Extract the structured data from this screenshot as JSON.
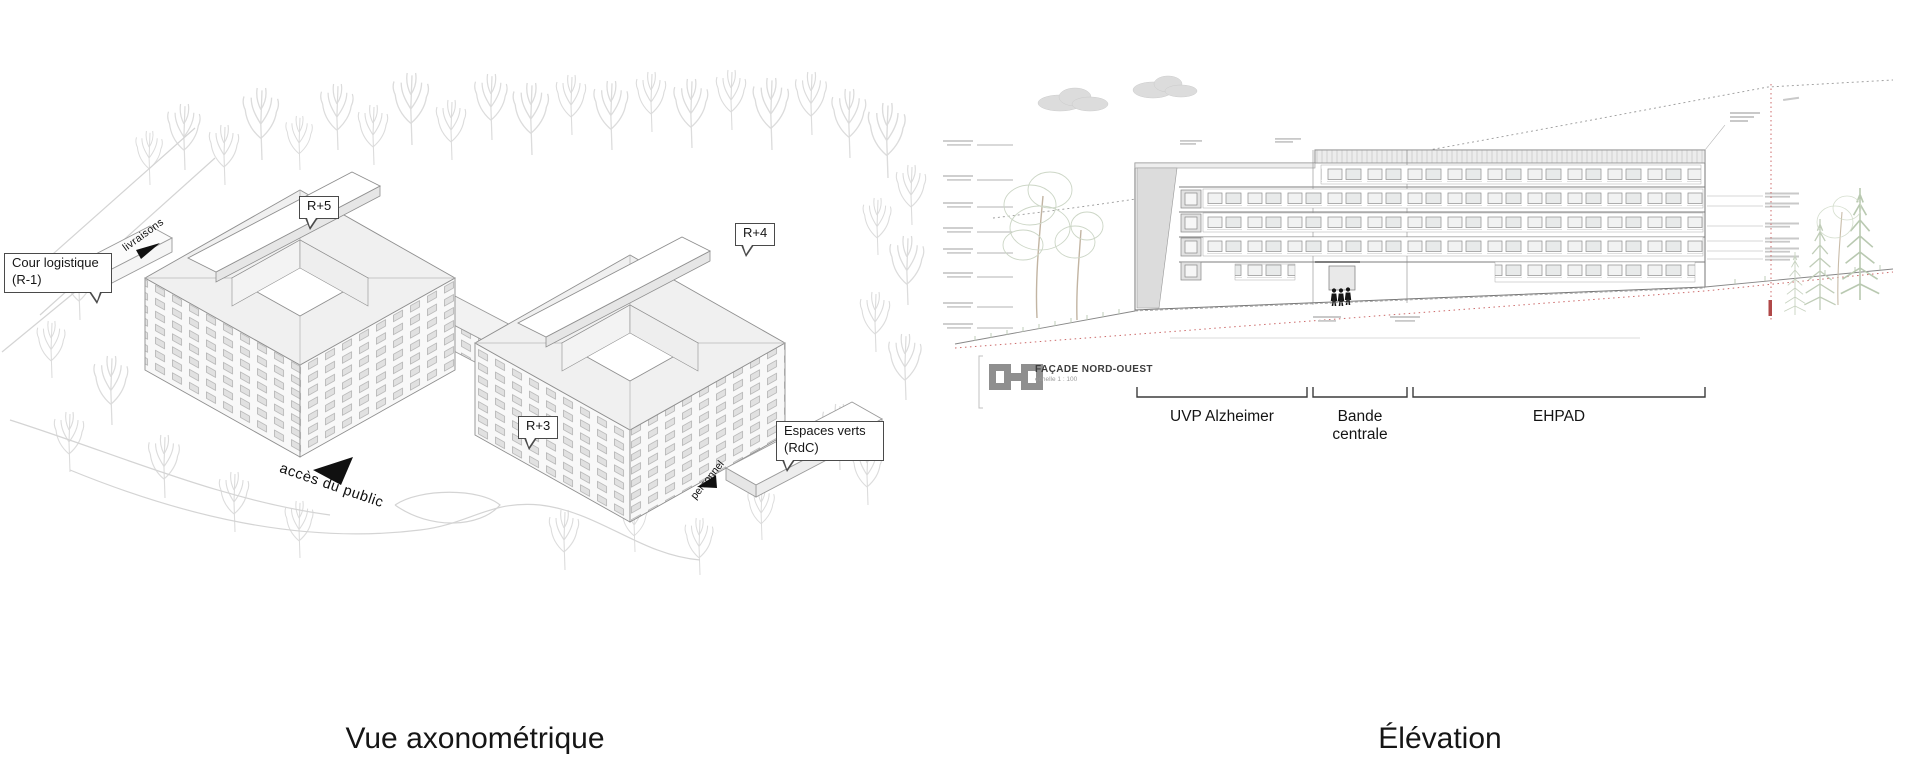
{
  "slide": {
    "background_color": "#ffffff",
    "line_color": "#9a9a9a",
    "text_color": "#1a1a1a",
    "boundary_red": "#cc6a6a",
    "vegetation_green": "#c0cdb8",
    "logo_gray": "#8f8f8f"
  },
  "axonometric": {
    "caption": "Vue axonométrique",
    "callouts": [
      {
        "id": "cour-logistique",
        "text": "Cour logistique\n(R-1)"
      },
      {
        "id": "r5",
        "text": "R+5"
      },
      {
        "id": "r4",
        "text": "R+4"
      },
      {
        "id": "r3",
        "text": "R+3"
      },
      {
        "id": "espaces-verts",
        "text": "Espaces verts\n(RdC)"
      }
    ],
    "flow_labels": [
      {
        "id": "livraisons",
        "text": "livraisons"
      },
      {
        "id": "acces-public",
        "text": "accès du public"
      },
      {
        "id": "personnel",
        "text": "personnel"
      }
    ]
  },
  "elevation": {
    "caption": "Élévation",
    "title_block": {
      "title": "FAÇADE NORD-OUEST",
      "scale_note": "échelle 1 : 100",
      "logo_icon": "key-plan-icon"
    },
    "sections": [
      {
        "label": "UVP Alzheimer"
      },
      {
        "label": "Bande\ncentrale"
      },
      {
        "label": "EHPAD"
      }
    ]
  }
}
